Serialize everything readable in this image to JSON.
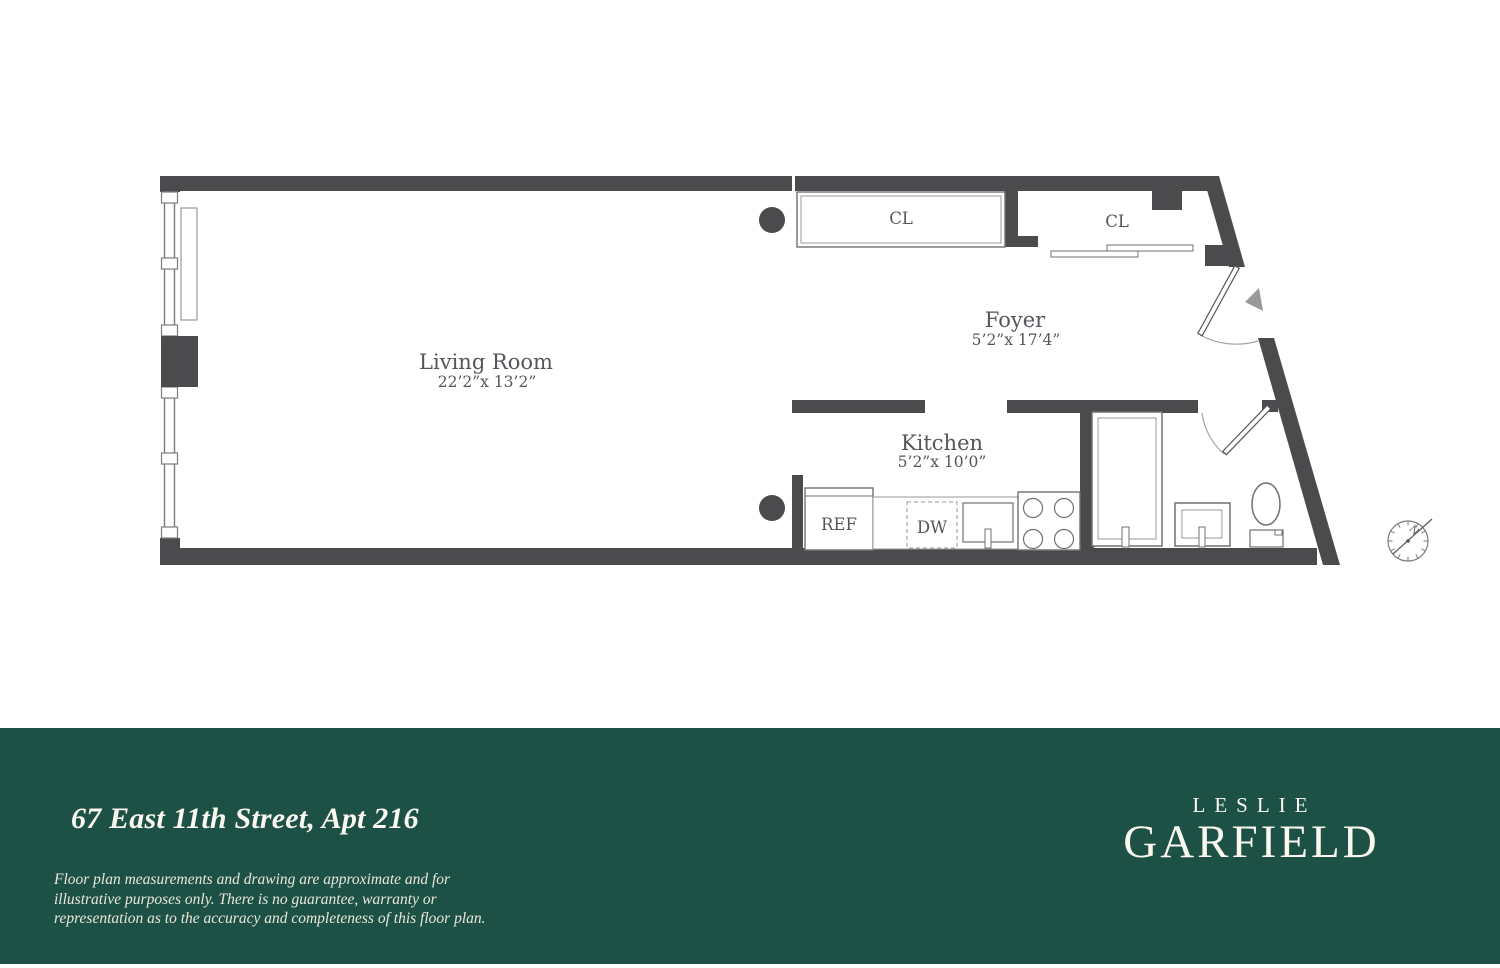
{
  "plan": {
    "living_room": {
      "label": "Living Room",
      "dims": "22’2”x 13’2”"
    },
    "foyer": {
      "label": "Foyer",
      "dims": "5’2”x 17’4”"
    },
    "kitchen": {
      "label": "Kitchen",
      "dims": "5’2”x 10’0”"
    },
    "closet_left_label": "CL",
    "closet_right_label": "CL",
    "fridge_label": "REF",
    "dishwasher_label": "DW",
    "compass_north": "N"
  },
  "footer": {
    "address": "67 East 11th Street, Apt 216",
    "disclaimer_lines": [
      "Floor plan measurements and drawing are approximate and for",
      "illustrative purposes only. There is no guarantee, warranty or",
      "representation as to the accuracy and completeness of this floor plan."
    ],
    "brand_top": "LESLIE",
    "brand_bottom": "GARFIELD"
  },
  "colors": {
    "wall": "#4b4b4d",
    "line": "#6f7073",
    "thin": "#98999b",
    "text": "#55565b",
    "arc": "#a3a4a6",
    "green": "#1e5146",
    "cream": "#faf8f1",
    "cream-dim": "#e9e7db"
  }
}
